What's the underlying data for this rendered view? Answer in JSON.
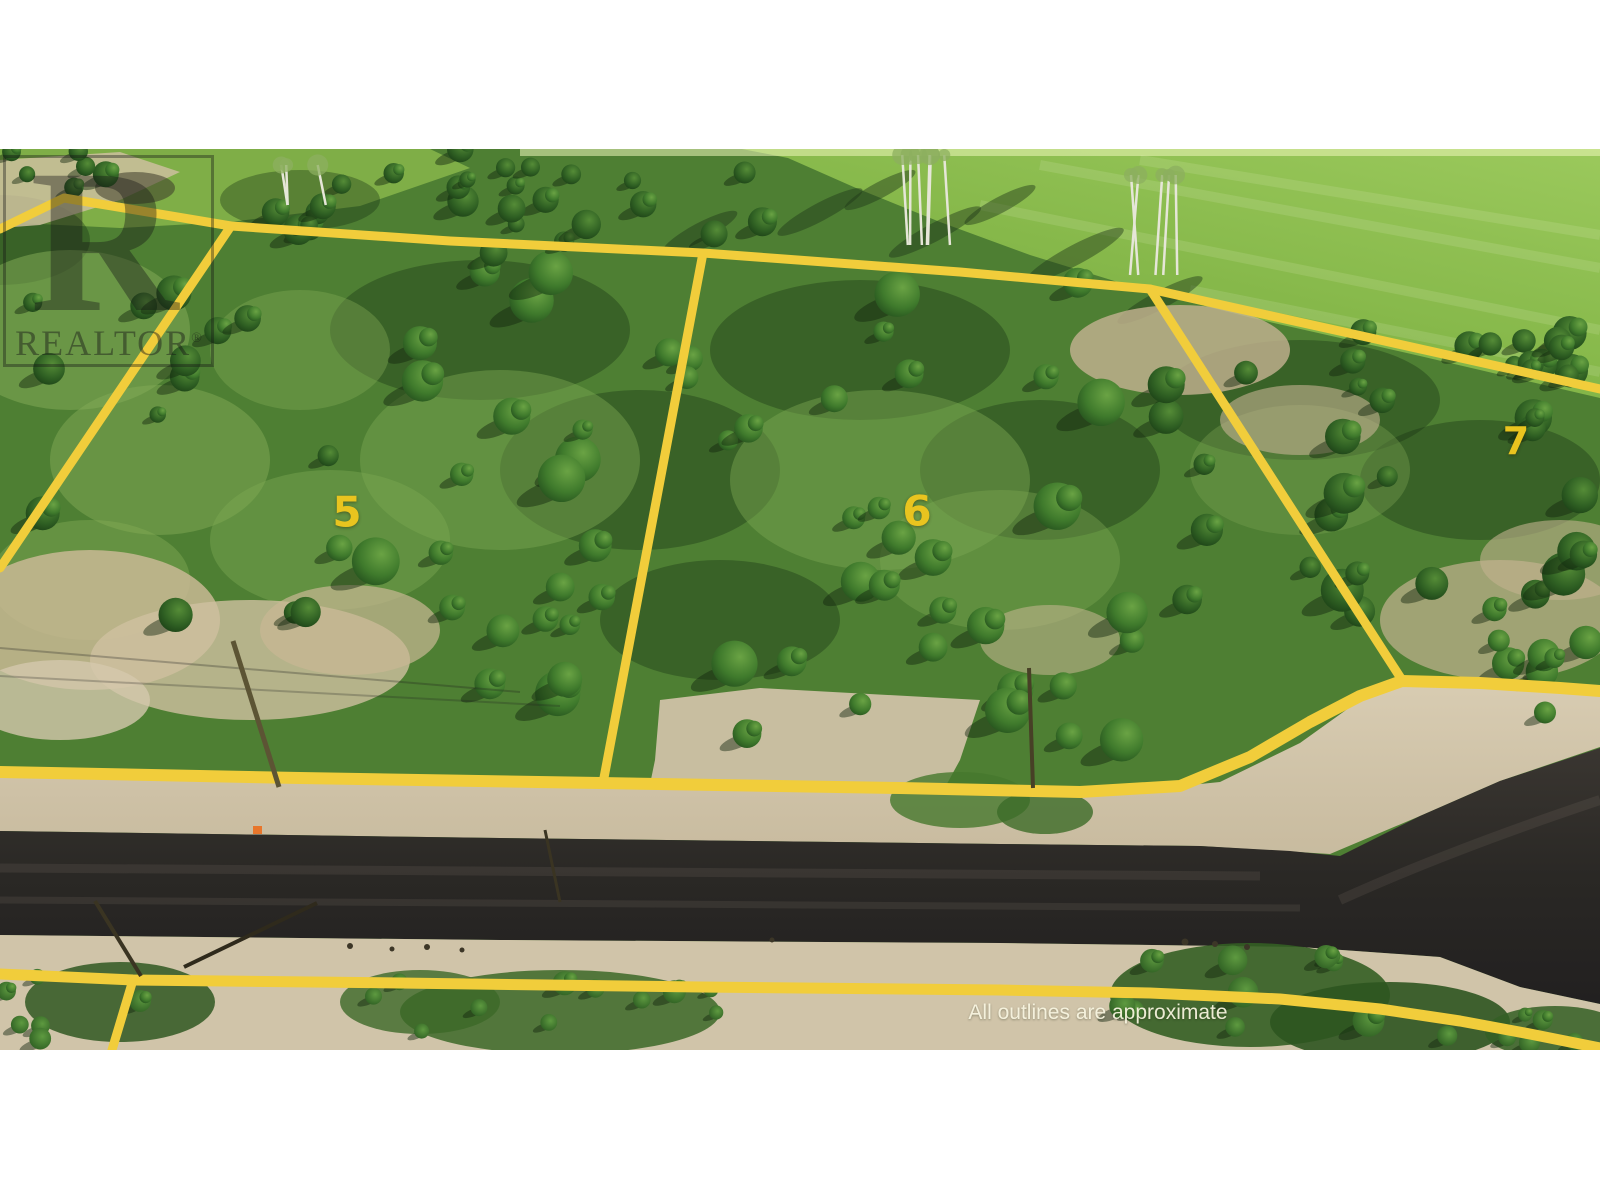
{
  "watermark": {
    "letter": "R",
    "brand": "REALTOR",
    "registered_symbol": "®"
  },
  "lot_labels": [
    {
      "label": "5"
    },
    {
      "label": "6"
    },
    {
      "label": "7"
    }
  ],
  "disclaimer": "All outlines are approximate",
  "colors": {
    "background_white": "#ffffff",
    "boundary_yellow": "#f1cd3b",
    "label_yellow": "#e9c41f",
    "field_green": "#8abb4e",
    "forest_green": "#4e7f33",
    "gravel_tan": "#d2c6ad",
    "asphalt_dark": "#2b2926",
    "marker_orange": "#e8762b",
    "watermark_black": "#161616"
  }
}
